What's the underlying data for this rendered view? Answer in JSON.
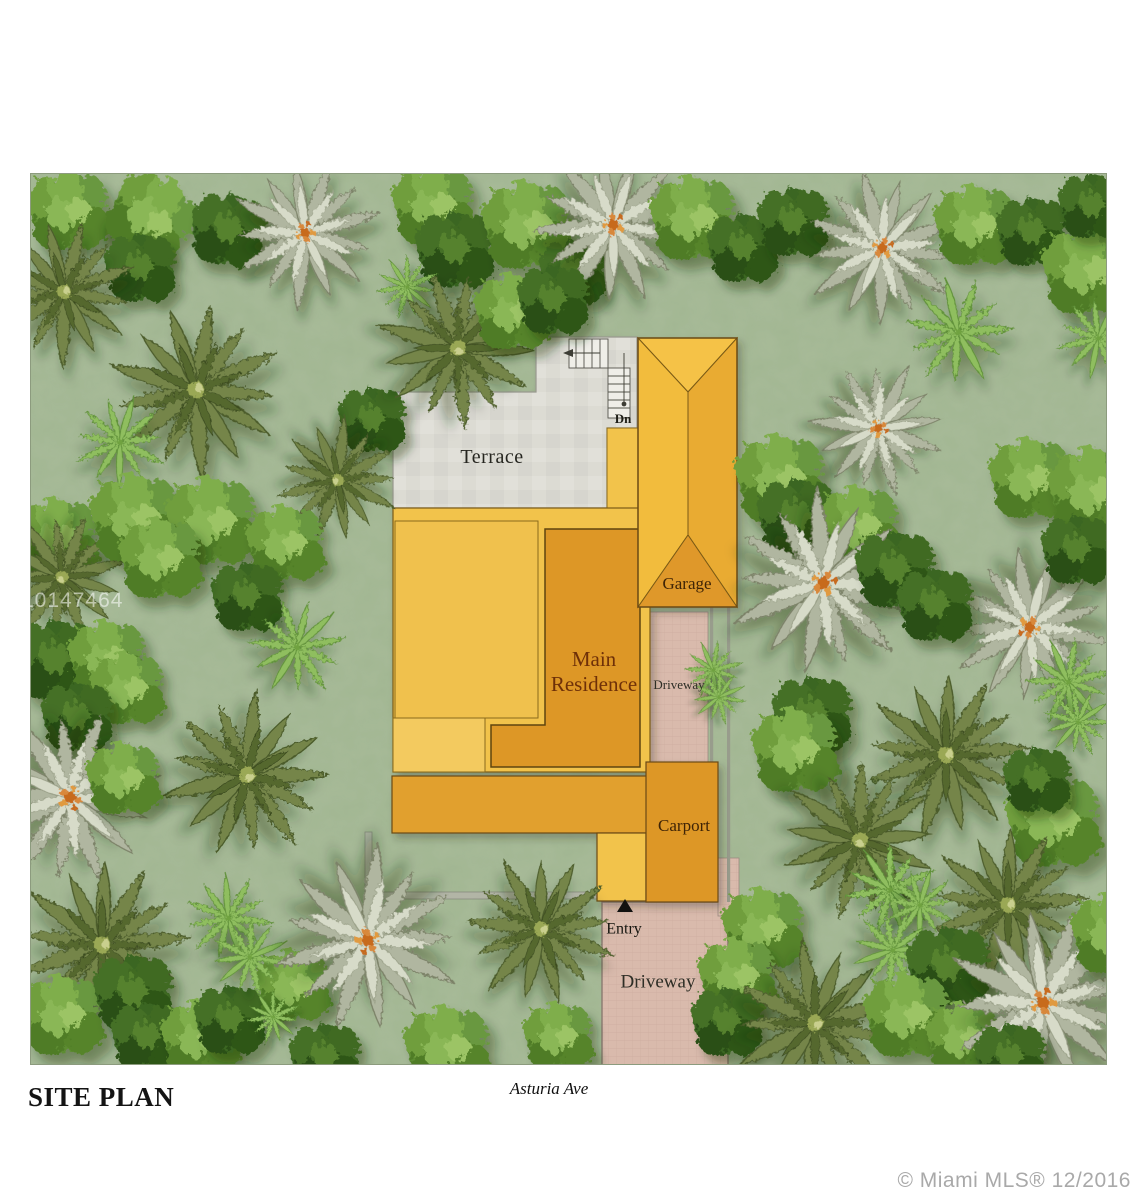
{
  "plan": {
    "title": "SITE PLAN",
    "street": "Asturia Ave",
    "watermark": "A10147464",
    "credit": "© Miami MLS® 12/2016",
    "areas": {
      "terrace": "Terrace",
      "garage": "Garage",
      "main_residence": "Main Residence",
      "carport": "Carport",
      "driveway_side": "Driveway",
      "driveway_front": "Driveway",
      "entry": "Entry",
      "stair_down": "Dn"
    },
    "colors": {
      "site_green": "#a8bb99",
      "roof_light": "#f2c34c",
      "roof_pale": "#f3ca5f",
      "roof_medium": "#e9ab31",
      "roof_dark": "#dd9728",
      "terrace_gray": "#dcdbd3",
      "driveway_pink": "#d9baac",
      "outline_brown": "#6b4a12",
      "label_brown": "#3f2406",
      "label_dark": "#262620",
      "wall_gray": "#b2b5a6"
    }
  }
}
